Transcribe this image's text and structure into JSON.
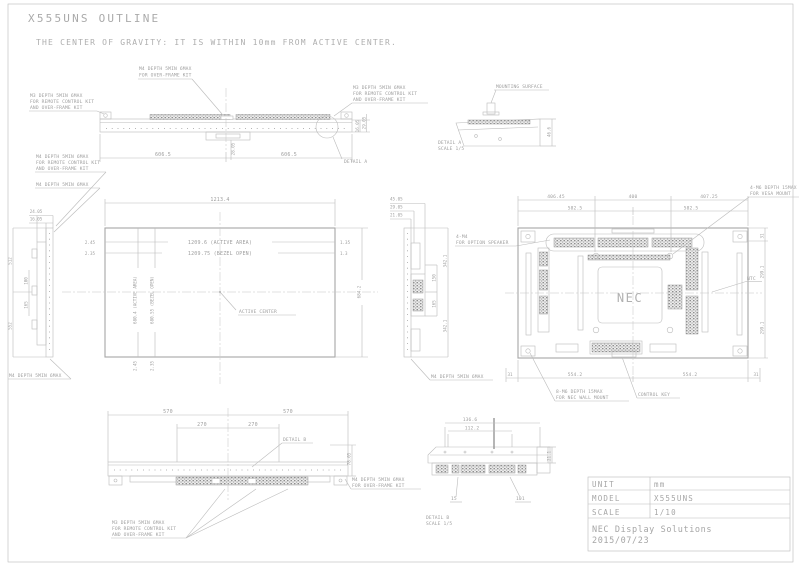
{
  "drawing": {
    "title": "X555UNS OUTLINE",
    "subtitle": "THE CENTER OF GRAVITY: IT IS WITHIN 10mm FROM ACTIVE CENTER.",
    "colors": {
      "line": "#bbbbbb",
      "text": "#9e9e9e",
      "background": "#ffffff"
    }
  },
  "top_view": {
    "note_overframe": {
      "line1": "M4 DEPTH 5MIN 6MAX",
      "line2": "FOR OVER-FRAME KIT"
    },
    "note_left": {
      "line1": "M3 DEPTH 5MIN 6MAX",
      "line2": "FOR REMOTE CONTROL KIT",
      "line3": "AND OVER-FRAME KIT"
    },
    "note_right": {
      "line1": "M3 DEPTH 5MIN 6MAX",
      "line2": "FOR REMOTE CONTROL KIT",
      "line3": "AND OVER-FRAME KIT"
    },
    "dim_half_left": "606.5",
    "dim_half_right": "606.5",
    "dim_depth_1": "16.05",
    "dim_depth_2": "29.05",
    "dim_center_depth": "28.05",
    "detail_label": "DETAIL A"
  },
  "detail_a": {
    "mounting_surface": "MOUNTING SURFACE",
    "caption": "DETAIL A",
    "scale": "SCALE 1/5",
    "dim_depth": "46.6"
  },
  "front_view": {
    "dim_width": "1213.4",
    "dim_active_width": "1209.6 (ACTIVE AREA)",
    "dim_bezel_width": "1209.75 (BEZEL OPEN)",
    "dim_left_top": "2.45",
    "dim_left_bottom": "2.35",
    "dim_right_top": "1.35",
    "dim_right_bottom": "1.3",
    "dim_active_height": "680.4 (ACTIVE AREA)",
    "dim_bezel_height": "680.55 (BEZEL OPEN)",
    "dim_bottom_left_1": "2.45",
    "dim_bottom_left_2": "2.35",
    "dim_height": "684.2",
    "active_center": "ACTIVE CENTER"
  },
  "left_view": {
    "note_top": {
      "line1": "M4 DEPTH 5MIN 6MAX",
      "line2": "FOR REMOTE CONTROL KIT",
      "line3": "AND OVER-FRAME KIT"
    },
    "note_mid": "M4 DEPTH 5MIN 6MAX",
    "note_bottom": "M4 DEPTH 5MIN 6MAX",
    "dim_depth_1": "24.05",
    "dim_depth_2": "16.05",
    "dim_v1": "512",
    "dim_v2": "100",
    "dim_v3": "165",
    "dim_v4": "552"
  },
  "right_view": {
    "dim_depth_1": "45.05",
    "dim_depth_2": "29.05",
    "dim_depth_3": "21.05",
    "dim_v1": "342.1",
    "dim_v2": "150",
    "dim_v3": "165",
    "dim_v4": "342.1",
    "note_speaker": {
      "line1": "4-M4",
      "line2": "FOR OPTION SPEAKER"
    },
    "note_bottom": "M4 DEPTH 5MIN 6MAX"
  },
  "rear_view": {
    "dim_top_1": "406.45",
    "dim_top_2": "400",
    "dim_top_3": "407.25",
    "dim_top_4": "582.5",
    "dim_top_5": "582.5",
    "note_vesa": {
      "line1": "4-M6 DEPTH 15MAX",
      "line2": "FOR VESA MOUNT"
    },
    "note_wall": {
      "line1": "8-M6 DEPTH 15MAX",
      "line2": "FOR NEC WALL MOUNT"
    },
    "note_control": "CONTROL KEY",
    "label_ntc": "NTC",
    "logo": "NEC",
    "dim_bottom_1": "31",
    "dim_bottom_2": "554.2",
    "dim_bottom_3": "554.2",
    "dim_bottom_4": "31",
    "dim_right_1": "31",
    "dim_right_2": "299.1",
    "dim_right_3": "299.1"
  },
  "bottom_view": {
    "dim_1": "570",
    "dim_2": "570",
    "dim_3": "270",
    "dim_4": "270",
    "detail_label": "DETAIL B",
    "dim_depth": "78.05",
    "note_right": {
      "line1": "M4 DEPTH 5MIN 6MAX",
      "line2": "FOR OVER-FRAME KIT"
    },
    "note_left": {
      "line1": "M3 DEPTH 5MIN 6MAX",
      "line2": "FOR REMOTE CONTROL KIT",
      "line3": "AND OVER-FRAME KIT"
    }
  },
  "detail_b": {
    "dim_1": "136.6",
    "dim_2": "112.2",
    "label_1": "15",
    "label_2": "101",
    "dim_right": "21.1",
    "caption": "DETAIL B",
    "scale": "SCALE 1/5"
  },
  "title_block": {
    "rows": [
      {
        "label": "UNIT",
        "value": "mm"
      },
      {
        "label": "MODEL",
        "value": "X555UNS"
      },
      {
        "label": "SCALE",
        "value": "1/10"
      }
    ],
    "company": "NEC Display Solutions",
    "date": "2015/07/23"
  }
}
